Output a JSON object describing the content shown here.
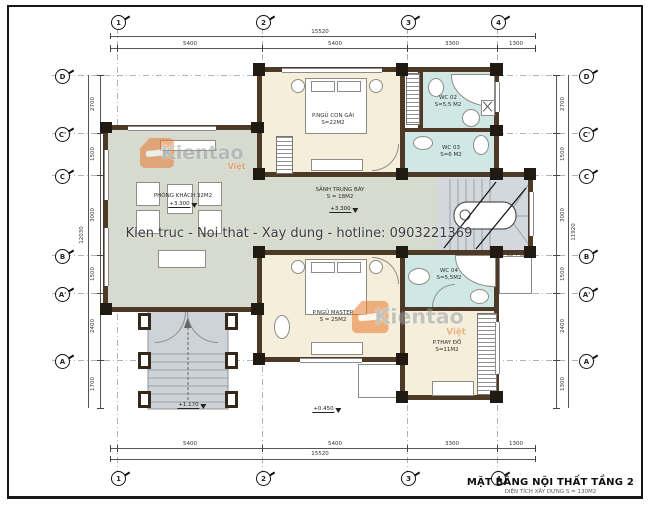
{
  "drawing": {
    "banner_text": "Kien truc - Noi that - Xay dung - hotline: 0903221369",
    "title": "MẶT BẰNG NỘI THẤT TẦNG 2",
    "subtitle": "DIỆN TÍCH XÂY DỰNG S = 130M2"
  },
  "watermark": {
    "brand": "Kientao",
    "suffix": "Việt"
  },
  "grid": {
    "cols": [
      "1",
      "2",
      "3",
      "4"
    ],
    "rows": [
      "D",
      "C'",
      "C",
      "B",
      "A'",
      "A"
    ]
  },
  "dims": {
    "top": {
      "total": "15520",
      "segments": [
        "5400",
        "5400",
        "3300",
        "1300"
      ]
    },
    "bottom": {
      "total": "15520",
      "segments": [
        "5400",
        "5400",
        "3300",
        "1300"
      ]
    },
    "left": {
      "total": "12030",
      "segments": [
        "2700",
        "1500",
        "3000",
        "1500",
        "2400",
        "1700"
      ]
    },
    "right": {
      "total": "11920",
      "segments": [
        "2700",
        "1500",
        "3000",
        "1500",
        "2400",
        "1300"
      ]
    }
  },
  "rooms": {
    "living": {
      "name": "PHÒNG KHÁCH 32M2",
      "level": "+3.300"
    },
    "girl": {
      "name": "P.NGỦ CON GÁI",
      "area": "S=22M2"
    },
    "hall": {
      "name": "SẢNH TRUNG BÀY",
      "area": "S = 18M2",
      "level": "+3.300"
    },
    "wc2": {
      "name": "WC 02",
      "area": "S=5,5 M2"
    },
    "wc3": {
      "name": "WC 03",
      "area": "S=6 M2"
    },
    "master": {
      "name": "P.NGỦ MASTER",
      "area": "S = 25M2"
    },
    "wc4": {
      "name": "WC 04",
      "area": "S=5,5M2"
    },
    "dressing": {
      "name": "P.THAY ĐỒ",
      "area": "S=11M2"
    }
  },
  "levels": {
    "porch": "+1.170",
    "yard": "+0.450"
  }
}
